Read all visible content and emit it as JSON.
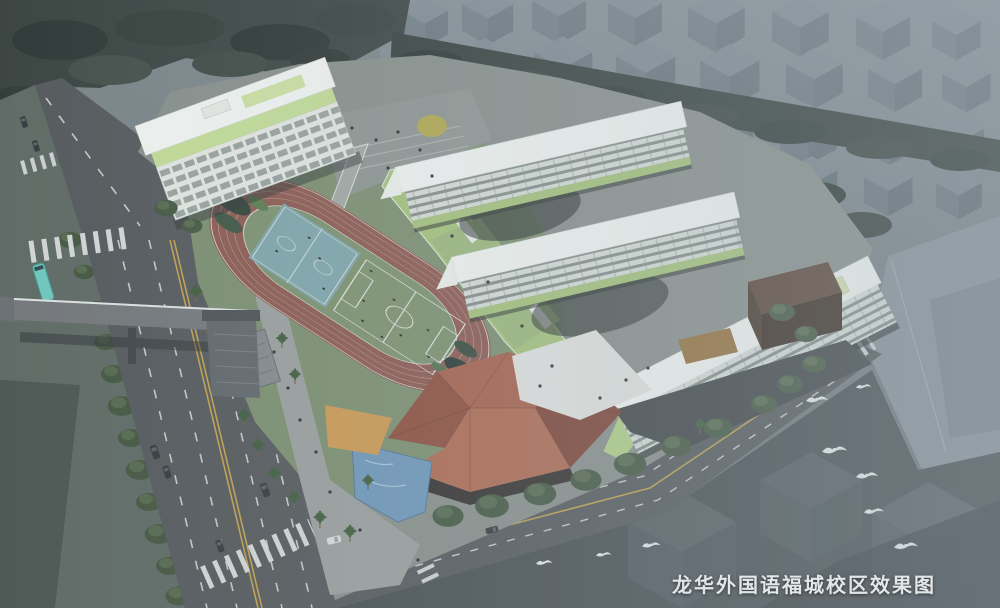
{
  "caption": {
    "text": "龙华外国语福城校区效果图"
  },
  "palette": {
    "track": "#8d584e",
    "field_green": "#7c916d",
    "court_blue": "#7fa6ab",
    "walkway_green": "#a6c47a",
    "band_green": "#c4df96",
    "roof_white": "#f5f7f3",
    "roof_terracotta": "#a85f49",
    "water_blue": "#6e97ba",
    "road_grey": "#54585a",
    "bus_teal": "#6fc9bf",
    "canopy_orange": "#cf9a4f"
  }
}
